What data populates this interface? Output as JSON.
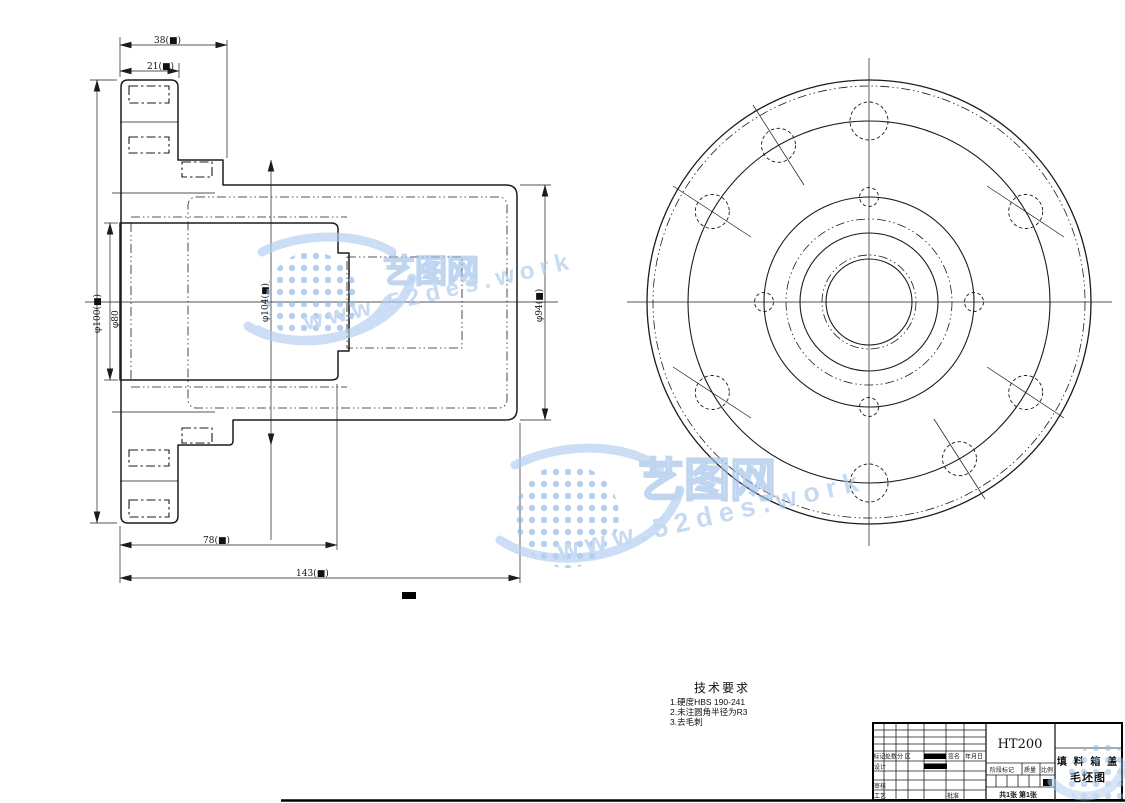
{
  "section_view": {
    "dims": {
      "top_width": "38(■)",
      "flange_width": "21(■)",
      "bore_depth": "78(■)",
      "total_length": "143(■)",
      "flange_dia": "φ100(■)",
      "bore_dia": "φ80",
      "step_dia": "φ104(■)",
      "body_dia": "φ94(■)"
    }
  },
  "tech_requirements": {
    "title": "技术要求",
    "item1": "1.硬度HBS 190-241",
    "item2": "2.未注圆角半径为R3",
    "item3": "3.去毛刺"
  },
  "watermark": {
    "brand": "艺图网",
    "site": "www.52des.work",
    "color": "#a9c7ec"
  },
  "title_block": {
    "material": "HT200",
    "part_name": "填 料 箱 盖",
    "drawing_type": "毛坯图",
    "labels": {
      "mark": "标记",
      "count": "处数",
      "zone": "分 区",
      "sign": "签名",
      "date": "年月日",
      "design": "设计",
      "check": "审核",
      "process": "工艺",
      "approve": "批准",
      "stage": "阶段标记",
      "mass": "质量",
      "scale": "比例"
    },
    "scale_value": "■",
    "sheet_info": "共1张 第1张"
  }
}
